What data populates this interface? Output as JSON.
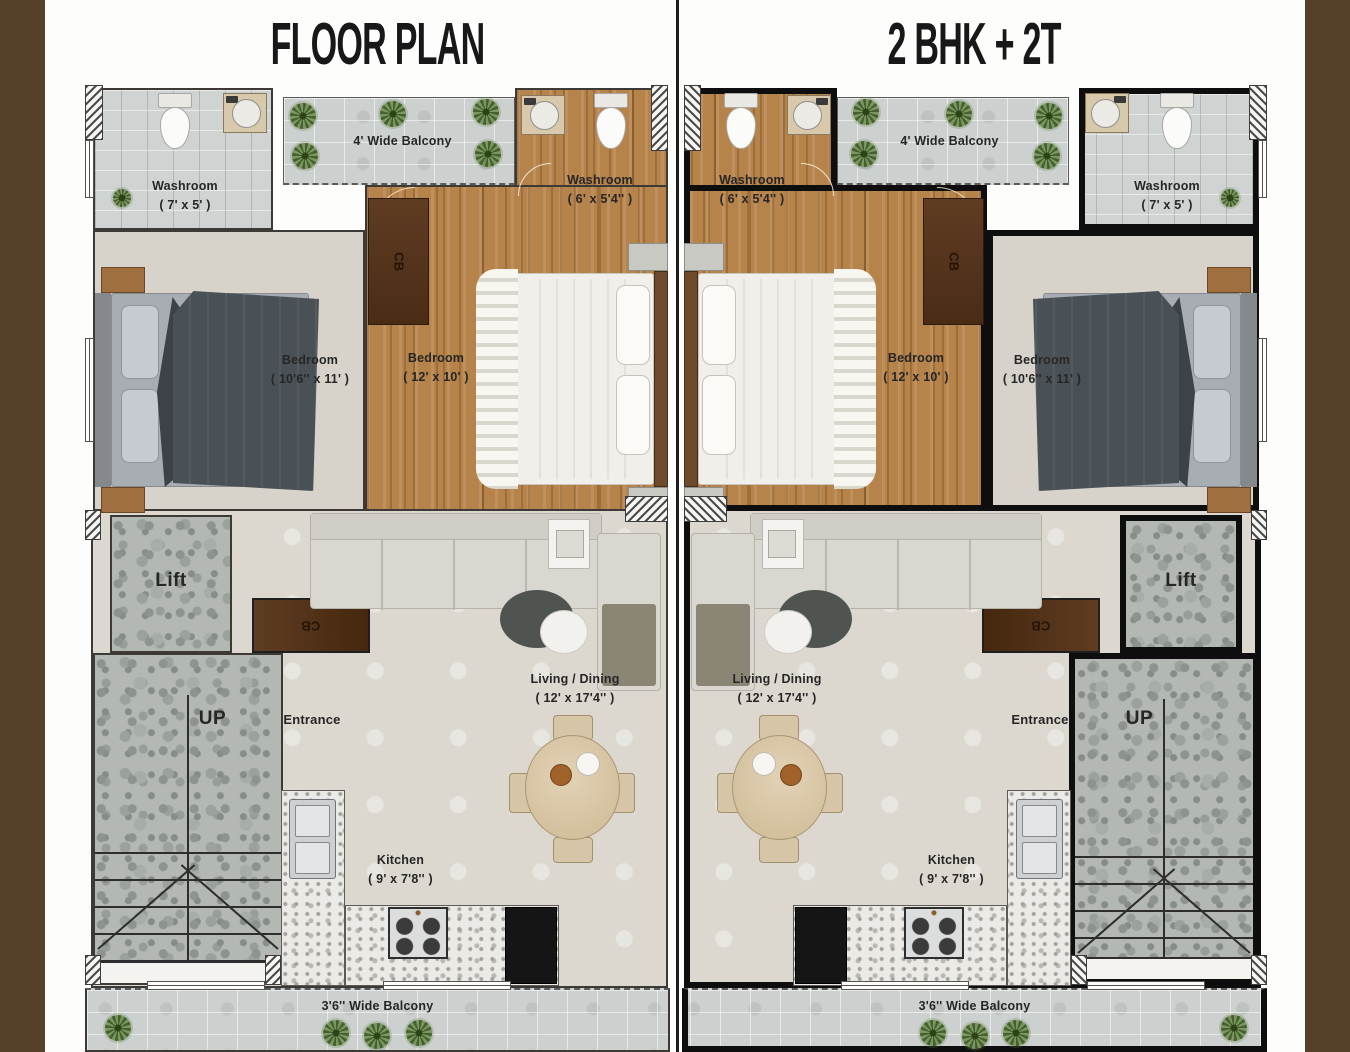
{
  "page": {
    "title_left": "FLOOR PLAN",
    "title_right": "2 BHK + 2T"
  },
  "rooms": {
    "washroom_small": {
      "name": "Washroom",
      "dims": "( 7' x 5' )"
    },
    "washroom_ensuite": {
      "name": "Washroom",
      "dims": "( 6' x 5'4'' )"
    },
    "balcony_top": {
      "name": "4' Wide Balcony"
    },
    "balcony_bottom": {
      "name": "3'6'' Wide Balcony"
    },
    "bedroom_second": {
      "name": "Bedroom",
      "dims": "( 10'6'' x 11' )"
    },
    "bedroom_master": {
      "name": "Bedroom",
      "dims": "( 12' x 10' )"
    },
    "living_dining": {
      "name": "Living / Dining",
      "dims": "( 12' x 17'4'' )"
    },
    "kitchen": {
      "name": "Kitchen",
      "dims": "( 9' x 7'8'' )"
    },
    "lift": {
      "name": "Lift"
    },
    "stairs": {
      "name": "UP"
    },
    "entrance": {
      "name": "Entrance"
    },
    "cupboard": {
      "name": "CB"
    }
  },
  "colors": {
    "frame_brown": "#57402a",
    "wall_black": "#0e0e0e",
    "wall_grey": "#3d3a36",
    "wood_floor": "#b6834b",
    "wardrobe_brown": "#5f3c22",
    "granite_grey": "#b3b8b3",
    "label_text": "#262626"
  }
}
